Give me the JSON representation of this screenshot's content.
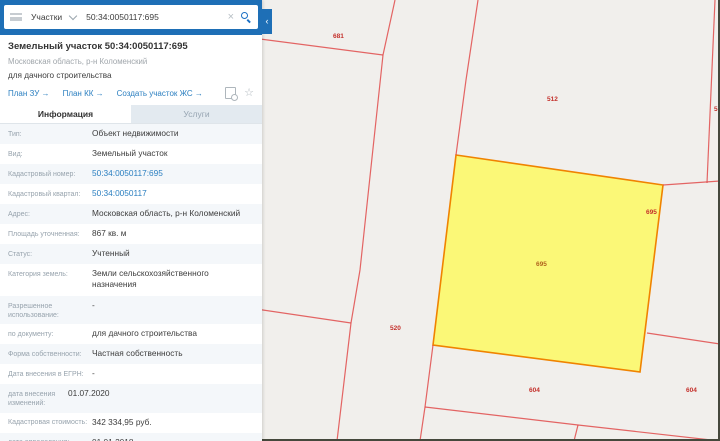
{
  "search": {
    "category": "Участки",
    "query": "50:34:0050117:695"
  },
  "panel": {
    "collapse_glyph": "‹",
    "clear_glyph": "×",
    "star_glyph": "☆"
  },
  "header": {
    "title": "Земельный участок 50:34:0050117:695",
    "subtitle": "Московская область, р-н Коломенский",
    "usage": "для дачного строительства",
    "links": [
      {
        "label": "План ЗУ →"
      },
      {
        "label": "План КК →"
      },
      {
        "label": "Создать участок ЖС →"
      }
    ]
  },
  "tabs": {
    "info": "Информация",
    "services": "Услуги"
  },
  "info": {
    "rows": [
      {
        "label": "Тип:",
        "value": "Объект недвижимости"
      },
      {
        "label": "Вид:",
        "value": "Земельный участок"
      },
      {
        "label": "Кадастровый номер:",
        "value": "50:34:0050117:695"
      },
      {
        "label": "Кадастровый квартал:",
        "value": "50:34:0050117"
      },
      {
        "label": "Адрес:",
        "value": "Московская область, р-н Коломенский"
      },
      {
        "label": "Площадь уточненная:",
        "value": "867 кв. м"
      },
      {
        "label": "Статус:",
        "value": "Учтенный"
      },
      {
        "label": "Категория земель:",
        "value": "Земли сельскохозяйственного назначения"
      },
      {
        "label": "Разрешенное использование:",
        "value": "-"
      },
      {
        "label": "по документу:",
        "value": "для дачного строительства"
      },
      {
        "label": "Форма собственности:",
        "value": "Частная собственность"
      },
      {
        "label": "Дата внесения в ЕГРН:",
        "value": "-"
      },
      {
        "label": "дата внесения изменений:",
        "value": "01.07.2020"
      },
      {
        "label": "Кадастровая стоимость:",
        "value": "342 334,95 руб."
      },
      {
        "label": "дата определения:",
        "value": "01.01.2018"
      }
    ]
  },
  "map": {
    "boundary_color": "#e14b4b",
    "selected_fill": "#fbf871",
    "selected_stroke": "#f08300",
    "labels": [
      {
        "text": "681",
        "x": 71,
        "y": 38,
        "color": "#c4302b"
      },
      {
        "text": "512",
        "x": 285,
        "y": 101,
        "color": "#c4302b"
      },
      {
        "text": "5",
        "x": 452,
        "y": 111,
        "color": "#c4302b"
      },
      {
        "text": "695",
        "x": 384,
        "y": 214,
        "color": "#c4302b"
      },
      {
        "text": "695",
        "x": 274,
        "y": 266,
        "color": "#b0641e"
      },
      {
        "text": "520",
        "x": 128,
        "y": 330,
        "color": "#c4302b"
      },
      {
        "text": "604",
        "x": 267,
        "y": 392,
        "color": "#c4302b"
      },
      {
        "text": "604",
        "x": 424,
        "y": 392,
        "color": "#c4302b"
      }
    ]
  }
}
